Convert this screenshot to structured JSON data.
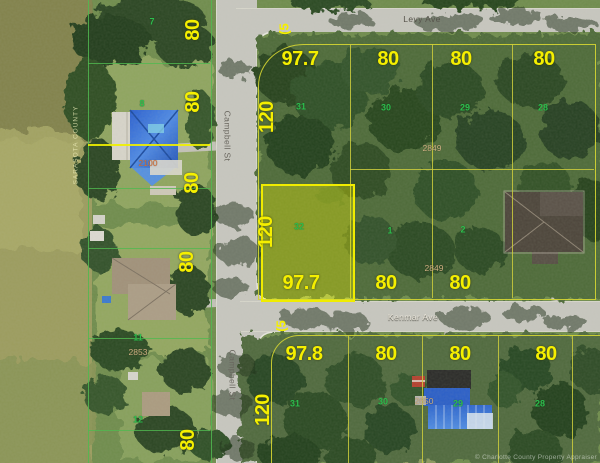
{
  "map": {
    "streets": {
      "top": "Levy Ave",
      "vertical": "Campbell St",
      "middle": "Kenmar Ave"
    },
    "watermarks": {
      "left_vertical": "SARASOTA COUNTY",
      "bottom_right": "© Charlotte County Property Appraiser"
    },
    "highlighted_parcel": {
      "frontage_label": "97.7",
      "depth_label": "120",
      "lot": "32"
    },
    "road_width_markers": [
      {
        "text": "(5",
        "x": 284,
        "y": 29
      },
      {
        "text": "(5",
        "x": 281,
        "y": 326
      }
    ],
    "dimension_labels": [
      {
        "text": "80",
        "x": 193,
        "y": 30,
        "rot": true
      },
      {
        "text": "80",
        "x": 193,
        "y": 102,
        "rot": true
      },
      {
        "text": "80",
        "x": 192,
        "y": 183,
        "rot": true
      },
      {
        "text": "80",
        "x": 187,
        "y": 262,
        "rot": true
      },
      {
        "text": "80",
        "x": 188,
        "y": 440,
        "rot": true
      },
      {
        "text": "97.7",
        "x": 300,
        "y": 59,
        "rot": false
      },
      {
        "text": "80",
        "x": 388,
        "y": 59,
        "rot": false
      },
      {
        "text": "80",
        "x": 461,
        "y": 59,
        "rot": false
      },
      {
        "text": "80",
        "x": 544,
        "y": 59,
        "rot": false
      },
      {
        "text": "120",
        "x": 267,
        "y": 117,
        "rot": true
      },
      {
        "text": "120",
        "x": 266,
        "y": 232,
        "rot": true
      },
      {
        "text": "97.7",
        "x": 301,
        "y": 283,
        "rot": false
      },
      {
        "text": "80",
        "x": 386,
        "y": 283,
        "rot": false
      },
      {
        "text": "80",
        "x": 460,
        "y": 283,
        "rot": false
      },
      {
        "text": "97.8",
        "x": 304,
        "y": 354,
        "rot": false
      },
      {
        "text": "80",
        "x": 386,
        "y": 354,
        "rot": false
      },
      {
        "text": "80",
        "x": 460,
        "y": 354,
        "rot": false
      },
      {
        "text": "80",
        "x": 546,
        "y": 354,
        "rot": false
      },
      {
        "text": "120",
        "x": 263,
        "y": 410,
        "rot": true
      }
    ],
    "lot_numbers": [
      {
        "text": "7",
        "x": 152,
        "y": 22
      },
      {
        "text": "8",
        "x": 142,
        "y": 104
      },
      {
        "text": "31",
        "x": 301,
        "y": 107
      },
      {
        "text": "30",
        "x": 386,
        "y": 108
      },
      {
        "text": "29",
        "x": 465,
        "y": 108
      },
      {
        "text": "28",
        "x": 543,
        "y": 108
      },
      {
        "text": "32",
        "x": 299,
        "y": 227
      },
      {
        "text": "1",
        "x": 390,
        "y": 231
      },
      {
        "text": "2",
        "x": 463,
        "y": 230
      },
      {
        "text": "11",
        "x": 138,
        "y": 338
      },
      {
        "text": "12",
        "x": 138,
        "y": 420
      },
      {
        "text": "31",
        "x": 295,
        "y": 404
      },
      {
        "text": "30",
        "x": 383,
        "y": 402
      },
      {
        "text": "29",
        "x": 458,
        "y": 404
      },
      {
        "text": "28",
        "x": 540,
        "y": 404
      }
    ],
    "parcel_ids": [
      {
        "text": "2100",
        "x": 148,
        "y": 163,
        "c": "#d4713d"
      },
      {
        "text": "2853",
        "x": 138,
        "y": 352,
        "c": "#cdb084"
      },
      {
        "text": "2849",
        "x": 432,
        "y": 148,
        "c": "#cdb084"
      },
      {
        "text": "2849",
        "x": 434,
        "y": 268,
        "c": "#cdb084"
      },
      {
        "text": "2650",
        "x": 424,
        "y": 401,
        "c": "#cdb084"
      }
    ],
    "colors": {
      "dimension_text": "#f5ef00",
      "lot_number_text": "#2ebe4e",
      "parcel_id_text": "#cdb084",
      "grid_line": "#cdcd3c",
      "lot_line_green": "#46b446",
      "highlight_fill": "rgba(252,252,0,0.32)",
      "road": "#c8c7c0"
    }
  }
}
